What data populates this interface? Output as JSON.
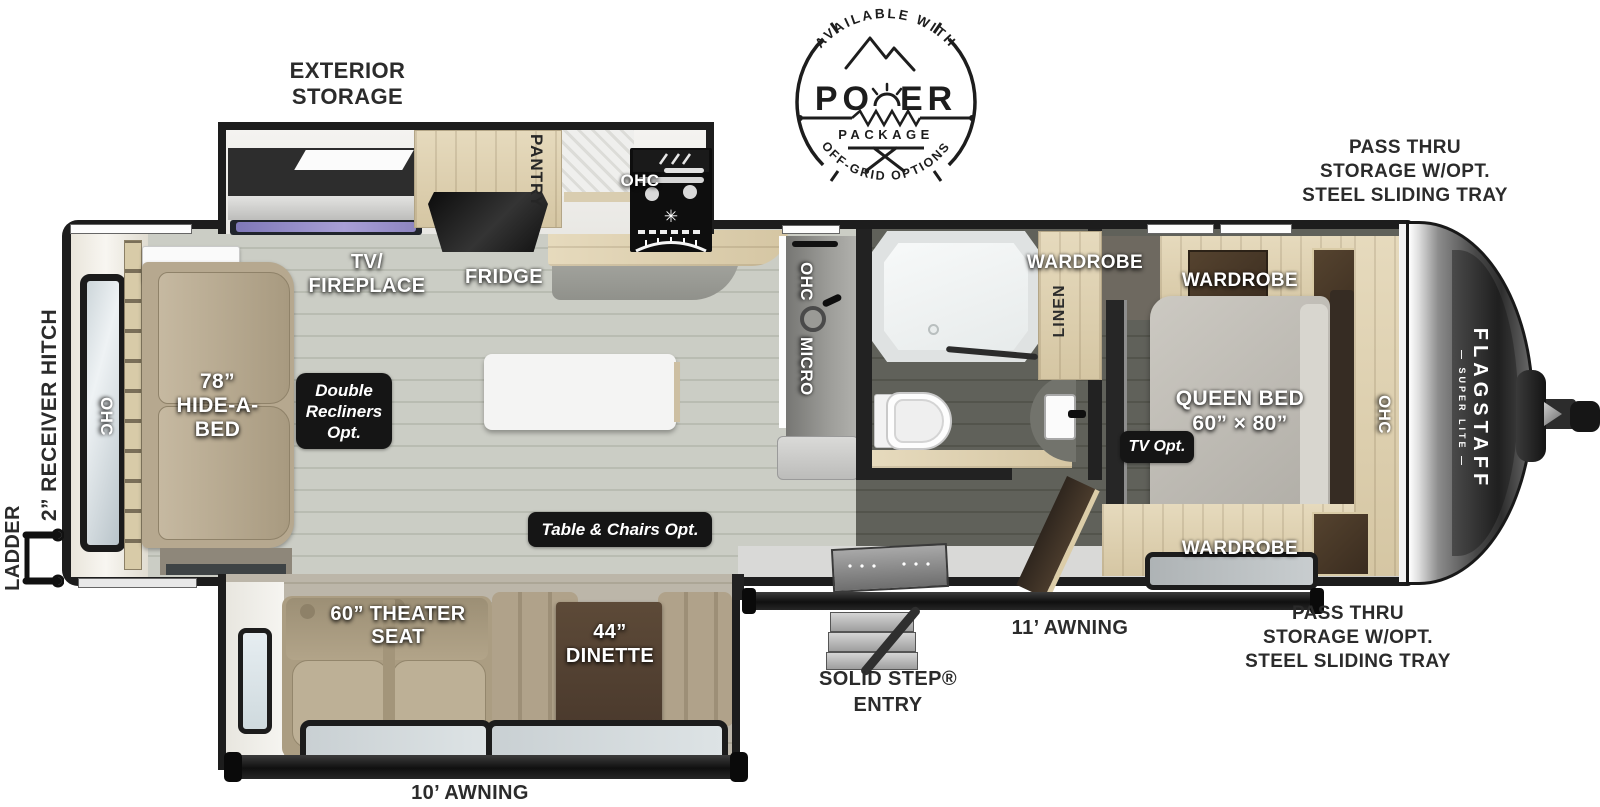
{
  "power_badge": {
    "arc_top": "AVAILABLE WITH",
    "title_po": "PO",
    "title_er": "ER",
    "package": "PACKAGE",
    "arc_bottom": "OFF-GRID OPTIONS"
  },
  "exterior": {
    "storage_label": "EXTERIOR\nSTORAGE",
    "pass_thru_front_upper": "PASS THRU\nSTORAGE W/OPT.\nSTEEL SLIDING TRAY",
    "pass_thru_front_lower": "PASS THRU\nSTORAGE W/OPT.\nSTEEL SLIDING TRAY",
    "receiver_hitch": "2” RECEIVER HITCH",
    "ladder": "LADDER",
    "solid_step_entry": "SOLID STEP®\nENTRY",
    "awning_door_side": "11’ AWNING",
    "awning_slide_side": "10’ AWNING"
  },
  "rear_lounge": {
    "ohc": "OHC",
    "hide_a_bed": "78”\nHIDE-A-\nBED",
    "double_recliners_opt": "Double\nRecliners\nOpt."
  },
  "kitchen": {
    "tv_fireplace": "TV/\nFIREPLACE",
    "fridge": "FRIDGE",
    "pantry": "PANTRY",
    "ohc": "OHC",
    "galley_ohc": "OHC",
    "micro": "MICRO",
    "table_chairs_opt": "Table & Chairs Opt."
  },
  "slide_room": {
    "theater_seat": "60” THEATER\nSEAT",
    "dinette": "44”\nDINETTE"
  },
  "bath": {
    "wardrobe": "WARDROBE",
    "linen": "LINEN"
  },
  "bedroom": {
    "wardrobe_top": "WARDROBE",
    "wardrobe_bottom": "WARDROBE",
    "queen_bed": "QUEEN BED\n60” × 80”",
    "tv_opt": "TV Opt.",
    "ohc": "OHC"
  },
  "front_cap": {
    "brand": "FLAGSTAFF",
    "series": "— SUPER LITE —"
  },
  "colors": {
    "outline": "#1d1d1d",
    "floor_light": "#c7c9c1",
    "floor_dark": "#57584f",
    "wood_light": "#ddd0b2",
    "wood_dark": "#4a3a2c",
    "upholstery": "#b4a68c",
    "badge_bg": "#151515",
    "label_dark": "#2b2b2b",
    "tv_screen": "#8d85c0",
    "window_glass": "#cfdde6"
  }
}
